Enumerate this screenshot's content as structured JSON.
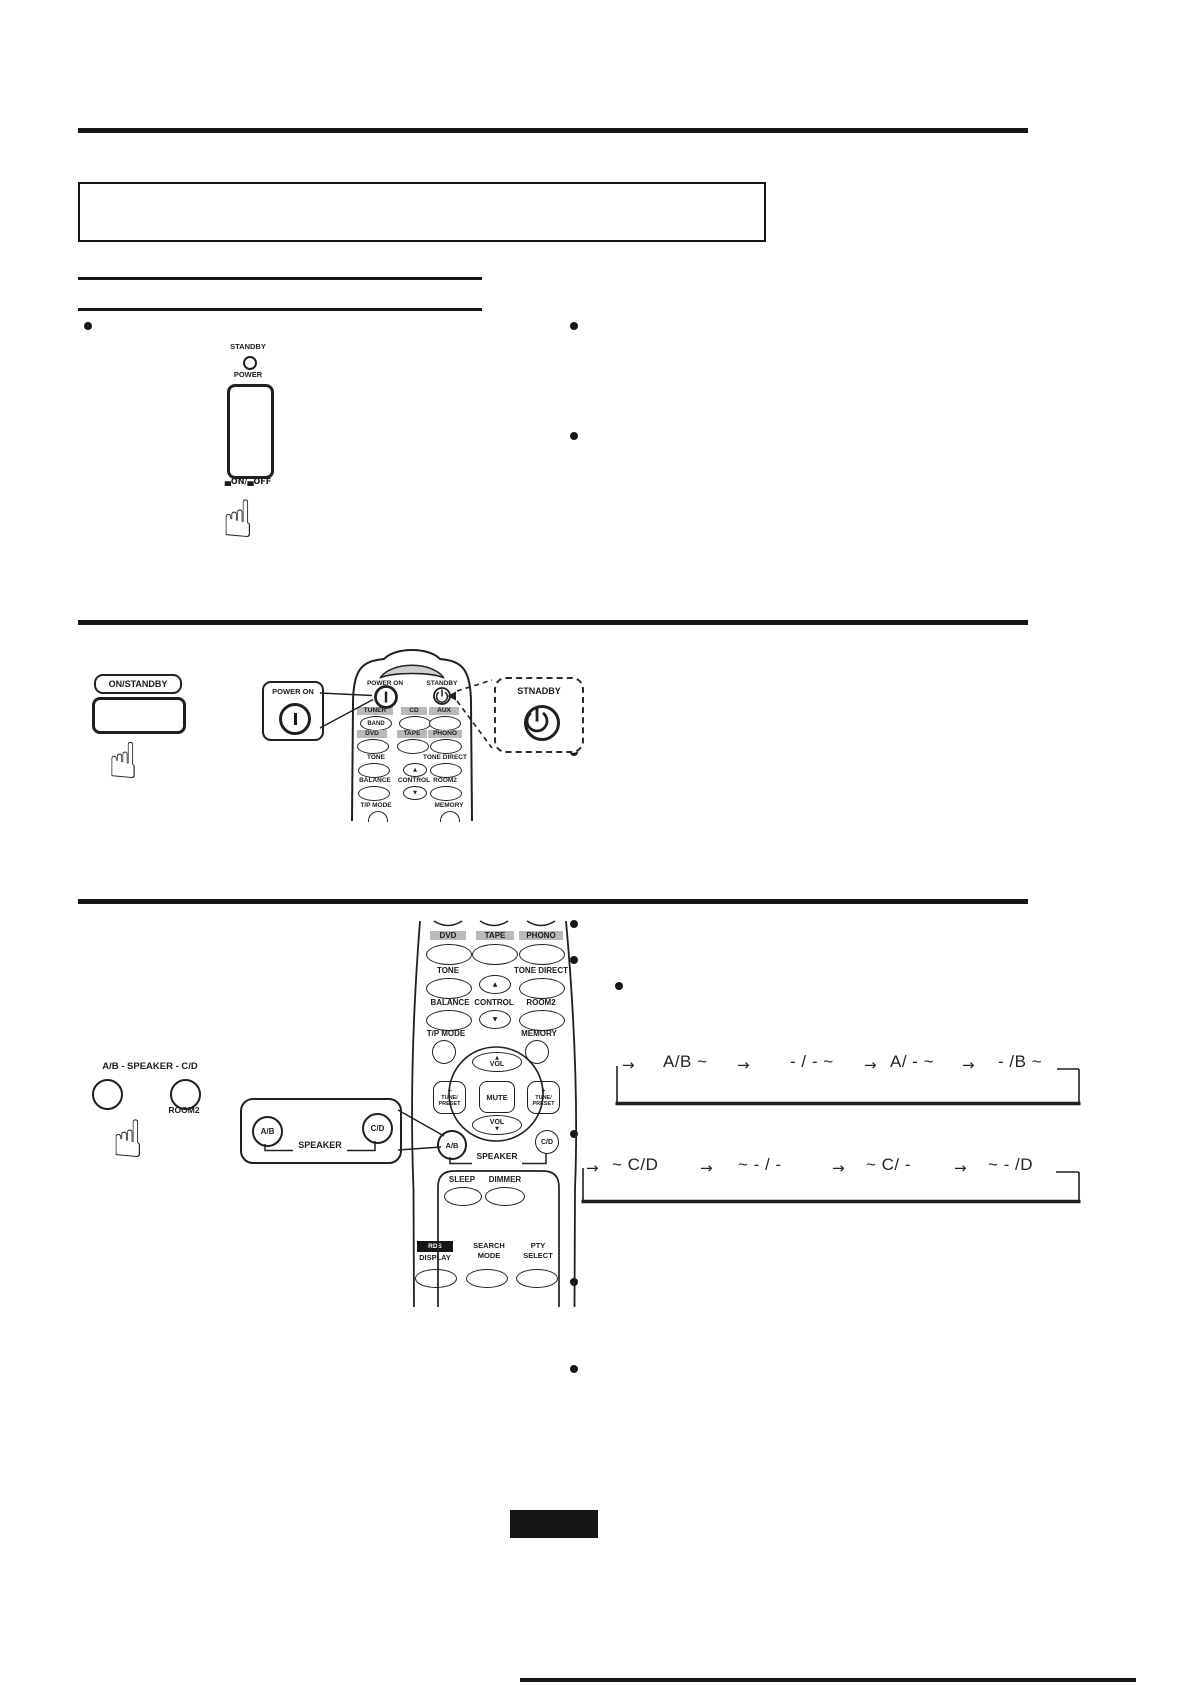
{
  "icons": {
    "hand": "☝",
    "up": "▲",
    "down": "▼",
    "arrow": "→"
  },
  "section1": {
    "standby": "STANDBY",
    "power": "POWER",
    "onoff": "▄ON/▄OFF"
  },
  "section2": {
    "on_standby": "ON/STANDBY",
    "power_on_callout": "POWER ON",
    "standby_callout": "STNADBY",
    "remote": {
      "power_on": "POWER ON",
      "standby": "STANDBY",
      "tuner": "TUNER",
      "band": "BAND",
      "cd": "CD",
      "aux": "AUX",
      "dvd": "DVD",
      "tape": "TAPE",
      "phono": "PHONO",
      "tone": "TONE",
      "tone_direct": "TONE DIRECT",
      "balance": "BALANCE",
      "control": "CONTROL",
      "room2": "ROOM2",
      "tp_mode": "T/P MODE",
      "memory": "MEMORY"
    }
  },
  "section3": {
    "front_label": "A/B - SPEAKER - C/D",
    "room2": "ROOM2",
    "callout": {
      "ab": "A/B",
      "cd": "C/D",
      "speaker": "SPEAKER"
    },
    "remote": {
      "dvd": "DVD",
      "tape": "TAPE",
      "phono": "PHONO",
      "tone": "TONE",
      "tone_direct": "TONE DIRECT",
      "balance": "BALANCE",
      "control": "CONTROL",
      "room2": "ROOM2",
      "tp_mode": "T/P MODE",
      "memory": "MEMORY",
      "vol": "VOL",
      "mute": "MUTE",
      "minus": "−",
      "plus": "+",
      "tune": "TUNE/",
      "preset": "PRESET",
      "ab": "A/B",
      "cd": "C/D",
      "speaker": "SPEAKER",
      "sleep": "SLEEP",
      "dimmer": "DIMMER",
      "rds": "RDS",
      "display": "DISPLAY",
      "search": "SEARCH",
      "mode": "MODE",
      "pty": "PTY",
      "select": "SELECT"
    },
    "flow1": {
      "states": [
        "A/B ~",
        "- / - ~",
        "A/ - ~",
        "- /B ~"
      ]
    },
    "flow2": {
      "states": [
        "~ C/D",
        "~ - / -",
        "~ C/ -",
        "~ - /D"
      ]
    }
  }
}
